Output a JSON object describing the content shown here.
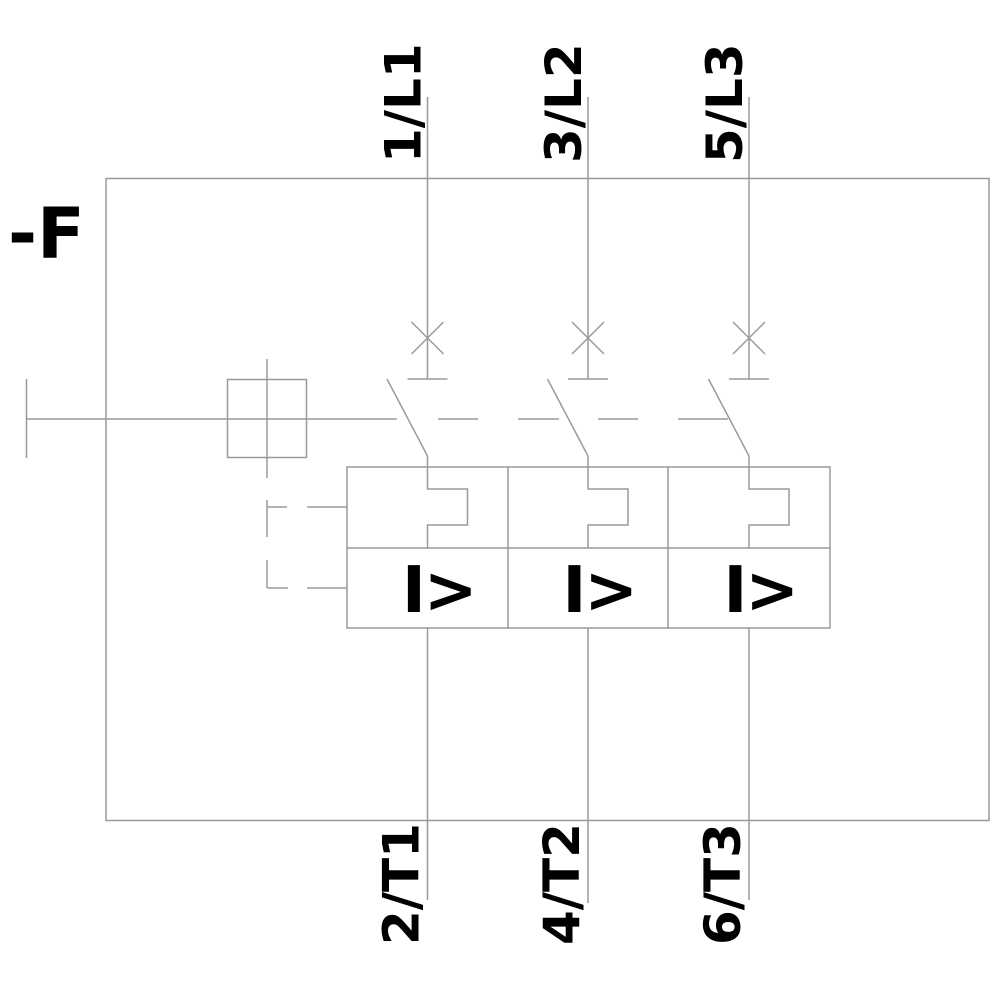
{
  "background": "#ffffff",
  "colors": {
    "line": "#9a9a9a",
    "text": "#000000"
  },
  "device": {
    "reference_label": "-F"
  },
  "poles": [
    {
      "top_terminal": "1/L1",
      "bottom_terminal": "2/T1",
      "magnetic_trip_label": "I>"
    },
    {
      "top_terminal": "3/L2",
      "bottom_terminal": "4/T2",
      "magnetic_trip_label": "I>"
    },
    {
      "top_terminal": "5/L3",
      "bottom_terminal": "6/T3",
      "magnetic_trip_label": "I>"
    }
  ],
  "icons": {
    "contact_position": "x-cross-icon",
    "thermal_release": "rect-bump-icon",
    "magnetic_release": "I>-text",
    "actuator": "square-box-icon",
    "trip_linkage": "dashed-line"
  }
}
